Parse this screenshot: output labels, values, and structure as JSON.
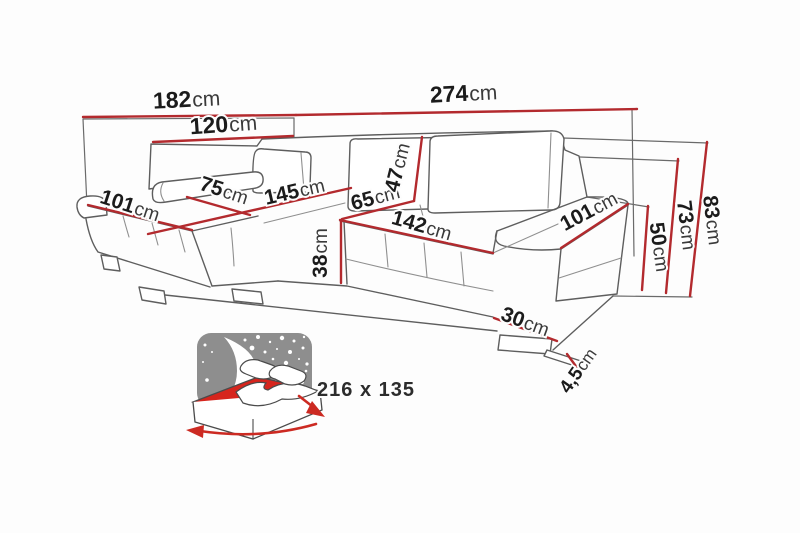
{
  "figure": {
    "type": "furniture-dimension-diagram",
    "subject": "corner sofa with sleeping function",
    "colors": {
      "background": "#fdfdfd",
      "dimension_red": "#b32a2e",
      "outline_gray": "#5e5e5e",
      "label_text": "#1b1b1b",
      "icon_gray": "#8e8e8e",
      "icon_red": "#d6251d"
    }
  },
  "dims": {
    "w182": {
      "v": "182",
      "u": "cm"
    },
    "w120": {
      "v": "120",
      "u": "cm"
    },
    "w274": {
      "v": "274",
      "u": "cm"
    },
    "d101l": {
      "v": "101",
      "u": "cm"
    },
    "w75": {
      "v": "75",
      "u": "cm"
    },
    "l145": {
      "v": "145",
      "u": "cm"
    },
    "d65": {
      "v": "65",
      "u": "cm"
    },
    "h47": {
      "v": "47",
      "u": "cm"
    },
    "w142": {
      "v": "142",
      "u": "cm"
    },
    "h38": {
      "v": "38",
      "u": "cm"
    },
    "d101r": {
      "v": "101",
      "u": "cm"
    },
    "w30": {
      "v": "30",
      "u": "cm"
    },
    "h50": {
      "v": "50",
      "u": "cm"
    },
    "h73": {
      "v": "73",
      "u": "cm"
    },
    "h83": {
      "v": "83",
      "u": "cm"
    },
    "h45": {
      "v": "4,5",
      "u": "cm"
    }
  },
  "bed": {
    "size_label": "216 x 135"
  }
}
